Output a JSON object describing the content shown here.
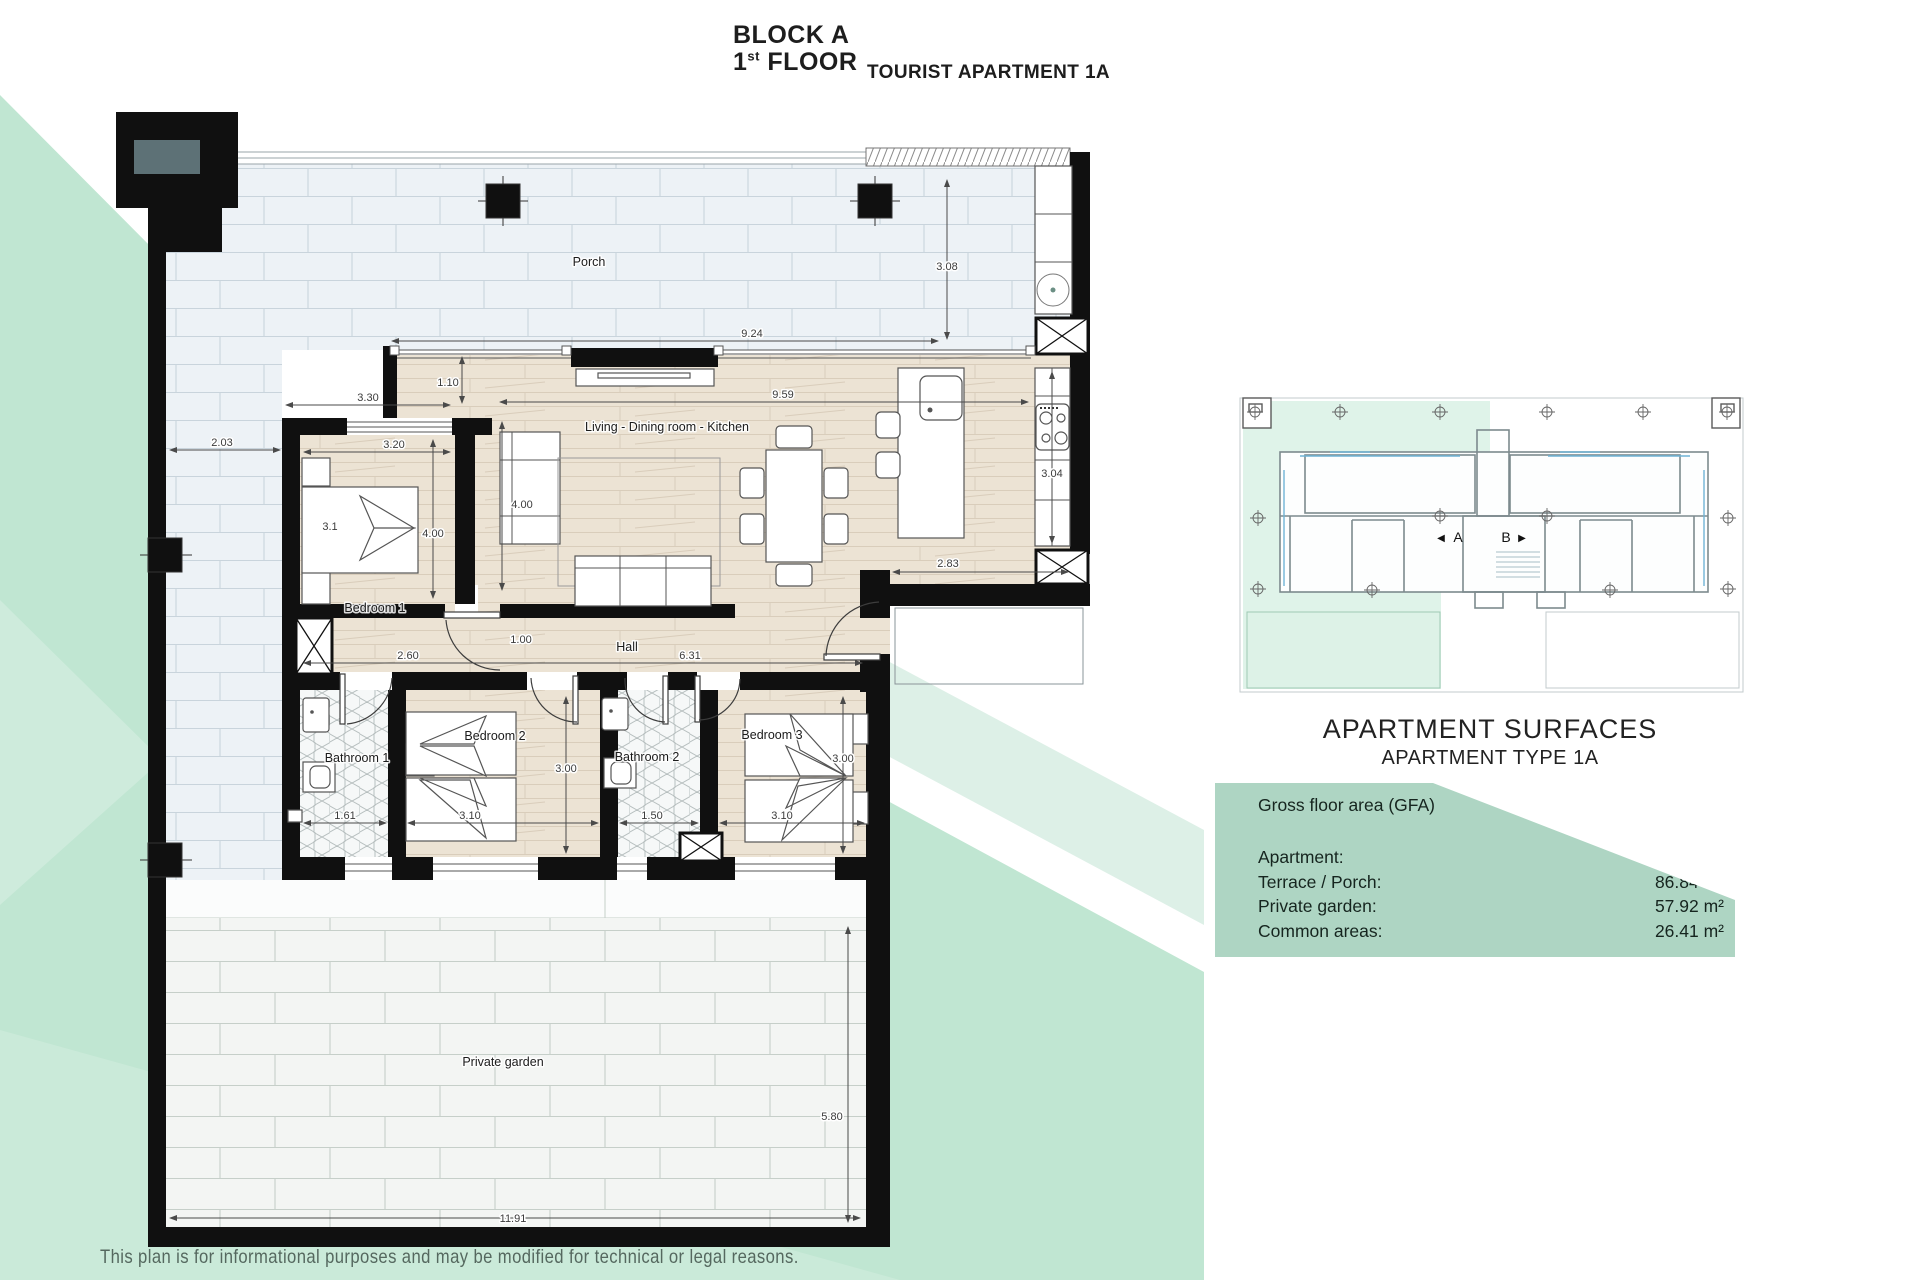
{
  "title": {
    "block": "BLOCK A",
    "floor_number": "1",
    "floor_ordinal": "st",
    "floor_label": " FLOOR",
    "subtitle": "TOURIST APARTMENT 1A"
  },
  "rooms": {
    "porch": "Porch",
    "living": "Living - Dining room - Kitchen",
    "bedroom1": "Bedroom 1",
    "bedroom2": "Bedroom 2",
    "bedroom3": "Bedroom 3",
    "bathroom1": "Bathroom 1",
    "bathroom2": "Bathroom 2",
    "hall": "Hall",
    "garden": "Private garden"
  },
  "dims": {
    "left_terrace_width": "2.03",
    "bedroom1_outer_width": "3.30",
    "front_setback": "1.10",
    "porch_length": "9.24",
    "porch_depth": "3.08",
    "living_length": "9.59",
    "living_depth": "4.00",
    "bedroom1_width": "3.20",
    "bedroom1_bed": "3.1",
    "bedroom1_depth": "4.00",
    "bedroom1_bottom": "2.60",
    "hall_door": "1.00",
    "hall_length": "6.31",
    "kitchen_exit": "2.83",
    "kitchen_depth": "3.04",
    "bathroom1_width": "1.61",
    "bedroom2_width": "3.10",
    "bedroom2_depth": "3.00",
    "bathroom2_width": "1.50",
    "bedroom3_width": "3.10",
    "bedroom3_depth": "3.00",
    "garden_depth": "5.80",
    "garden_width": "11.91"
  },
  "overview": {
    "marker_left": "◀",
    "unit_a": "A",
    "unit_b": "B",
    "marker_right": "▶"
  },
  "surfaces": {
    "heading": "APARTMENT SURFACES",
    "subheading": "APARTMENT TYPE 1A",
    "section": "Gross floor area (GFA)",
    "rows": [
      {
        "label": "Apartment:",
        "value": "97.47 m²"
      },
      {
        "label": "Terrace / Porch:",
        "value": "86.84 m²"
      },
      {
        "label": "Private garden:",
        "value": "57.92 m²"
      },
      {
        "label": "Common areas:",
        "value": "26.41 m²"
      }
    ]
  },
  "footer": {
    "disclaimer": "This plan is for informational purposes and may be modified for technical or legal reasons."
  },
  "colors": {
    "background_green": "#c0e6d2",
    "light_band_green": "#ddf0e7",
    "panel_green": "#aed5c3",
    "wall_black": "#101010"
  }
}
